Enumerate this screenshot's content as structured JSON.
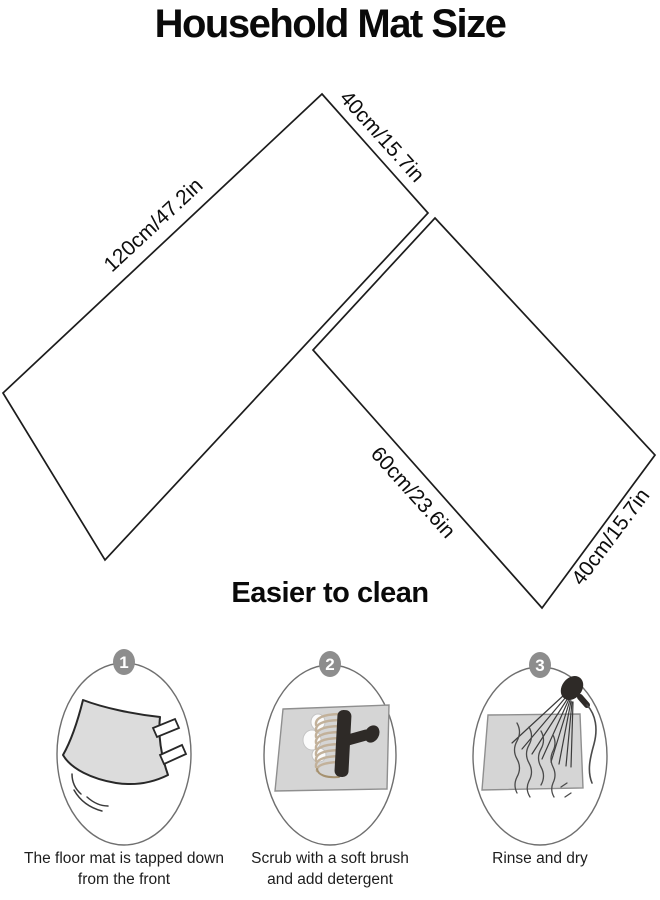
{
  "title": "Household Mat Size",
  "diagram": {
    "mat_runner": {
      "label_length": "120cm/47.2in",
      "label_width": "40cm/15.7in"
    },
    "mat_small": {
      "label_length": "60cm/23.6in",
      "label_width": "40cm/15.7in"
    }
  },
  "section": {
    "heading": "Easier to clean",
    "steps": [
      {
        "number": "1",
        "caption": [
          "The floor mat is tapped down",
          "from the front"
        ]
      },
      {
        "number": "2",
        "caption": [
          "Scrub with a soft brush",
          "and add detergent"
        ]
      },
      {
        "number": "3",
        "caption": [
          "Rinse and dry"
        ]
      }
    ]
  },
  "colors": {
    "background": "#ffffff",
    "outline": "#1c1c1c",
    "step_badge": "#8d8d8d",
    "illustration_mat_fill": "#d5d5d5",
    "brush_dark": "#2e2a27",
    "bristle_tan": "#c2b19a"
  }
}
